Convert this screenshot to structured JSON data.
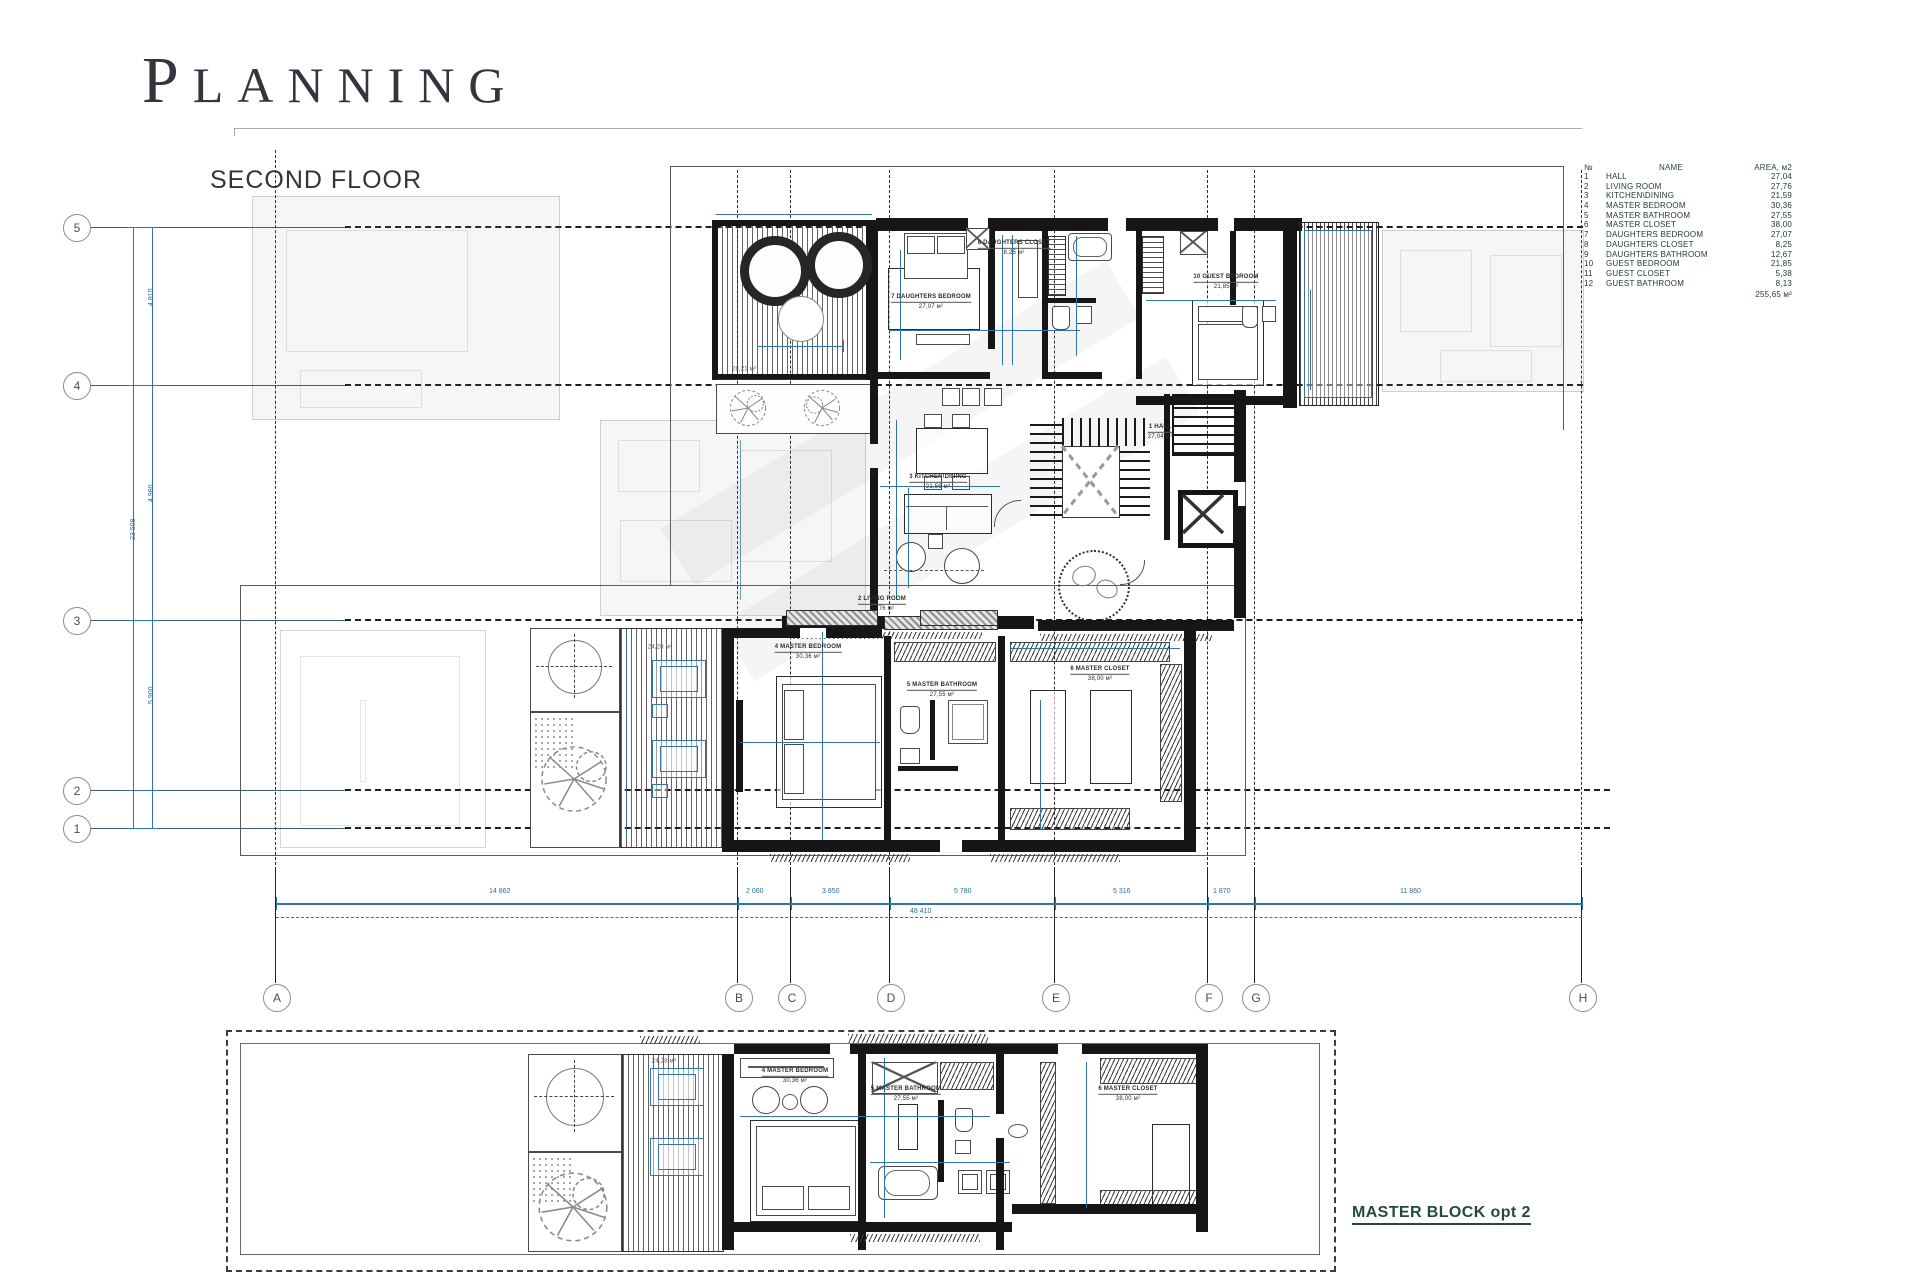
{
  "header": {
    "title_cap": "P",
    "title_rest": "LANNING",
    "subtitle": "SECOND FLOOR"
  },
  "legend": {
    "col_num": "№",
    "col_name": "NAME",
    "col_area": "AREA, м2",
    "rows": [
      [
        "1",
        "HALL",
        "27,04"
      ],
      [
        "2",
        "LIVING ROOM",
        "27,76"
      ],
      [
        "3",
        "KITCHEN\\DINING",
        "21,59"
      ],
      [
        "4",
        "MASTER BEDROOM",
        "30,36"
      ],
      [
        "5",
        "MASTER BATHROOM",
        "27,55"
      ],
      [
        "6",
        "MASTER CLOSET",
        "38,00"
      ],
      [
        "7",
        "DAUGHTERS BEDROOM",
        "27,07"
      ],
      [
        "8",
        "DAUGHTERS CLOSET",
        "8,25"
      ],
      [
        "9",
        "DAUGHTERS BATHROOM",
        "12,67"
      ],
      [
        "10",
        "GUEST BEDROOM",
        "21,85"
      ],
      [
        "11",
        "GUEST CLOSET",
        "5,38"
      ],
      [
        "12",
        "GUEST BATHROOM",
        "8,13"
      ]
    ],
    "total": "255,65 м²"
  },
  "grid": {
    "rows": [
      {
        "label": "5",
        "y": 227
      },
      {
        "label": "4",
        "y": 385
      },
      {
        "label": "3",
        "y": 620
      },
      {
        "label": "2",
        "y": 790
      },
      {
        "label": "1",
        "y": 828
      }
    ],
    "cols": [
      {
        "label": "A",
        "x": 276
      },
      {
        "label": "B",
        "x": 738
      },
      {
        "label": "C",
        "x": 791
      },
      {
        "label": "D",
        "x": 890
      },
      {
        "label": "E",
        "x": 1055
      },
      {
        "label": "F",
        "x": 1208
      },
      {
        "label": "G",
        "x": 1255
      },
      {
        "label": "H",
        "x": 1582
      }
    ]
  },
  "dimensions": {
    "spans": [
      {
        "text": "14 862",
        "x": 507
      },
      {
        "text": "2 060",
        "x": 764
      },
      {
        "text": "3 650",
        "x": 840
      },
      {
        "text": "5 780",
        "x": 972
      },
      {
        "text": "5 316",
        "x": 1131
      },
      {
        "text": "1 870",
        "x": 1231
      },
      {
        "text": "11 860",
        "x": 1418
      }
    ],
    "overall": "48 410",
    "left": [
      {
        "text": "4 810",
        "y": 306
      },
      {
        "text": "4 980",
        "y": 502
      },
      {
        "text": "5 900",
        "y": 704
      }
    ],
    "left_overall": "23 508"
  },
  "room_labels": [
    {
      "name": "7 DAUGHTERS BEDROOM",
      "area": "27,07 м²",
      "x": 931,
      "y": 302
    },
    {
      "name": "8 DAUGHTERS CLOSET",
      "area": "8,25 м²",
      "x": 1014,
      "y": 248
    },
    {
      "name": "10 GUEST BEDROOM",
      "area": "21,85 м²",
      "x": 1226,
      "y": 282
    },
    {
      "name": "1 HALL",
      "area": "27,04 м²",
      "x": 1160,
      "y": 432
    },
    {
      "name": "3 KITCHEN\\DINING",
      "area": "21,59 м²",
      "x": 938,
      "y": 482
    },
    {
      "name": "2 LIVING ROOM",
      "area": "27,76 м²",
      "x": 882,
      "y": 604
    },
    {
      "name": "4 MASTER BEDROOM",
      "area": "30,36 м²",
      "x": 808,
      "y": 652
    },
    {
      "name": "5 MASTER BATHROOM",
      "area": "27,55 м²",
      "x": 942,
      "y": 690
    },
    {
      "name": "6 MASTER CLOSET",
      "area": "38,00 м²",
      "x": 1100,
      "y": 674
    },
    {
      "name": "4 MASTER BEDROOM",
      "area": "30,36 м²",
      "x": 795,
      "y": 1076
    },
    {
      "name": "5 MASTER BATHROOM",
      "area": "27,55 м²",
      "x": 906,
      "y": 1094
    },
    {
      "name": "6 MASTER CLOSET",
      "area": "38,00 м²",
      "x": 1128,
      "y": 1094
    }
  ],
  "area_labels": [
    {
      "text": "28,21 м²",
      "x": 744,
      "y": 370
    },
    {
      "text": "24,28 м²",
      "x": 664,
      "y": 1062
    },
    {
      "text": "24,28 м²",
      "x": 660,
      "y": 648
    }
  ],
  "master_block": {
    "label": "MASTER BLOCK opt 2"
  }
}
